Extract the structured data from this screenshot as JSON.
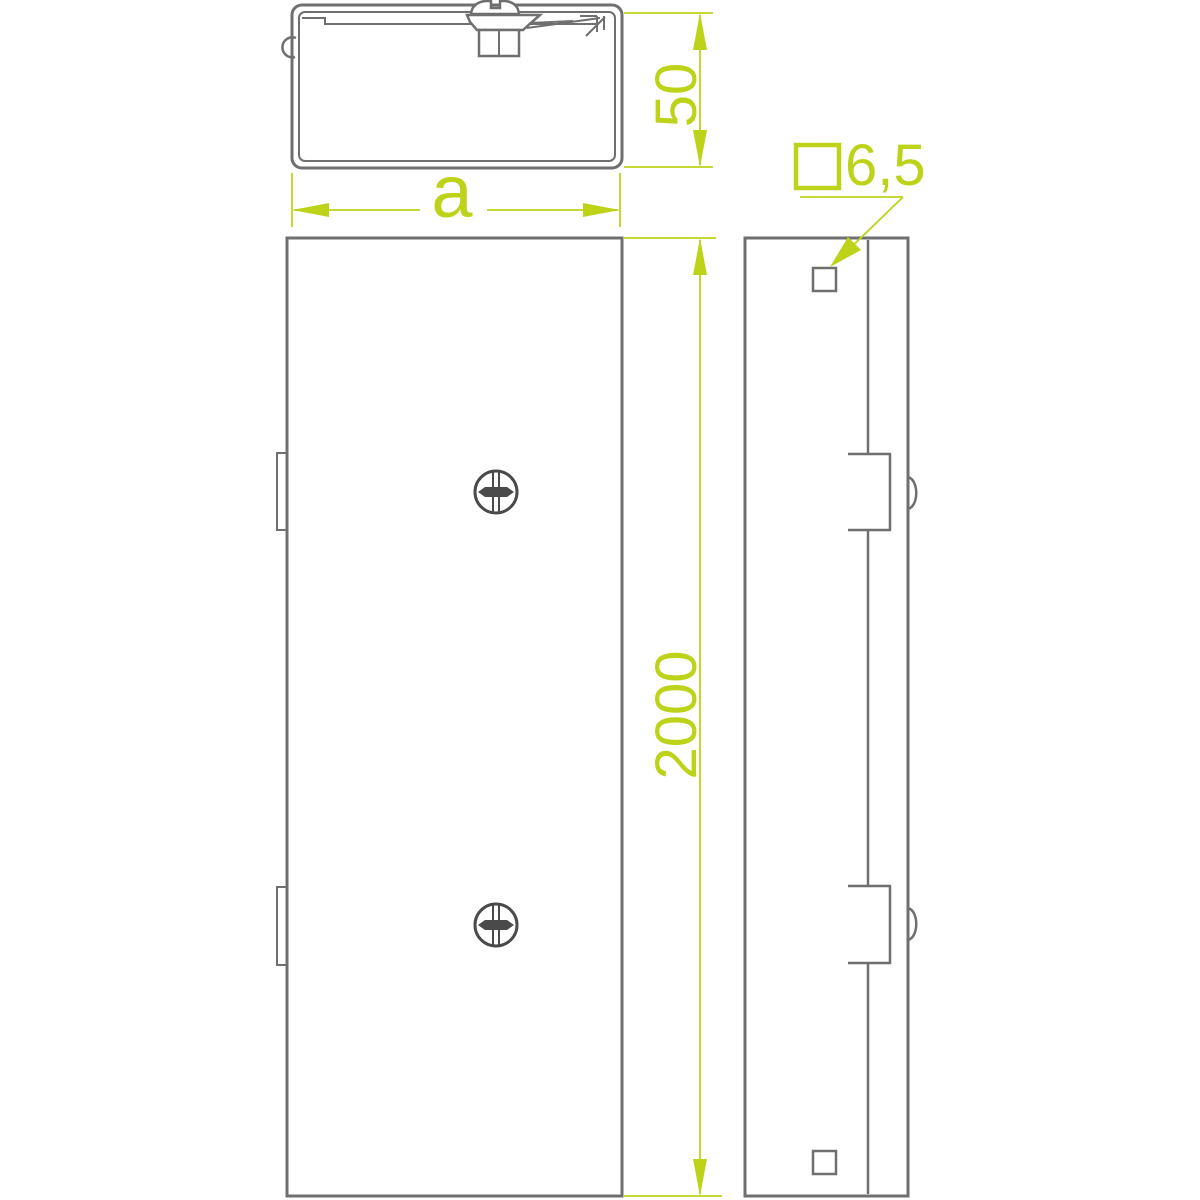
{
  "drawing": {
    "background": "#ffffff",
    "colors": {
      "outline_gray": "#6f6f6f",
      "screw_gray": "#4a4a4a",
      "dimension_green": "#bdd31a"
    },
    "dimensions": {
      "profile_height": {
        "value": "50",
        "orientation": "vertical"
      },
      "profile_width": {
        "value": "a",
        "orientation": "horizontal"
      },
      "length": {
        "value": "2000",
        "orientation": "vertical"
      },
      "hole_size": {
        "value": "6,5",
        "prefix_symbol": "square-symbol"
      }
    },
    "icons": {
      "phillips-screw-icon": "circle with cross slot",
      "square-symbol": "hollow square outline before hole dimension",
      "arrowhead-icon": "solid narrow triangle on dimension/leader lines"
    }
  }
}
